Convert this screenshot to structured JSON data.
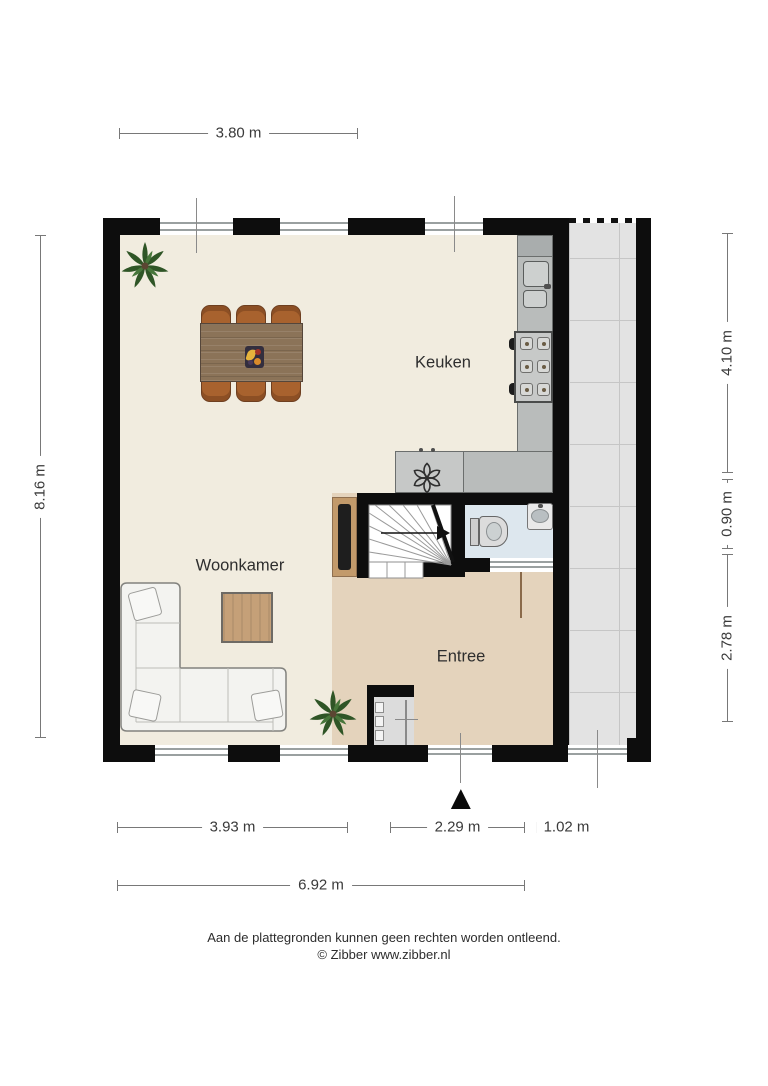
{
  "rooms": {
    "kitchen": "Keuken",
    "living_room": "Woonkamer",
    "entry": "Entree"
  },
  "dimensions": {
    "top": "3.80 m",
    "left": "8.16 m",
    "right": [
      "4.10 m",
      "0.90 m",
      "2.78 m"
    ],
    "bottom": [
      "3.93 m",
      "2.29 m",
      "1.02 m"
    ],
    "bottom_total": "6.92 m"
  },
  "footer": {
    "disclaimer": "Aan de plattegronden kunnen geen rechten worden ontleend.",
    "copyright": "© Zibber www.zibber.nl"
  },
  "icons": {
    "entrance_arrow": "▲",
    "ventilation_fan": "six-petal-fan",
    "plant": "potted-plant",
    "stairs_up_arrow": "right-arrow"
  },
  "colors": {
    "wall": "#0d0d0d",
    "floor_living_kitchen": "#f1ecdf",
    "floor_entry": "#e4d3bc",
    "floor_wc": "#dde7ee",
    "terrace_tiles": "#e3e3e3",
    "kitchen_counter": "#b9bcbb",
    "dining_table": "#8b7358",
    "dining_chair": "#a8622e",
    "sofa": "#f3f3f0",
    "coffee_table": "#c5a078",
    "tv_board": "#c29a6b",
    "plant_green": "#2f5526",
    "dimension_line": "#787878"
  }
}
